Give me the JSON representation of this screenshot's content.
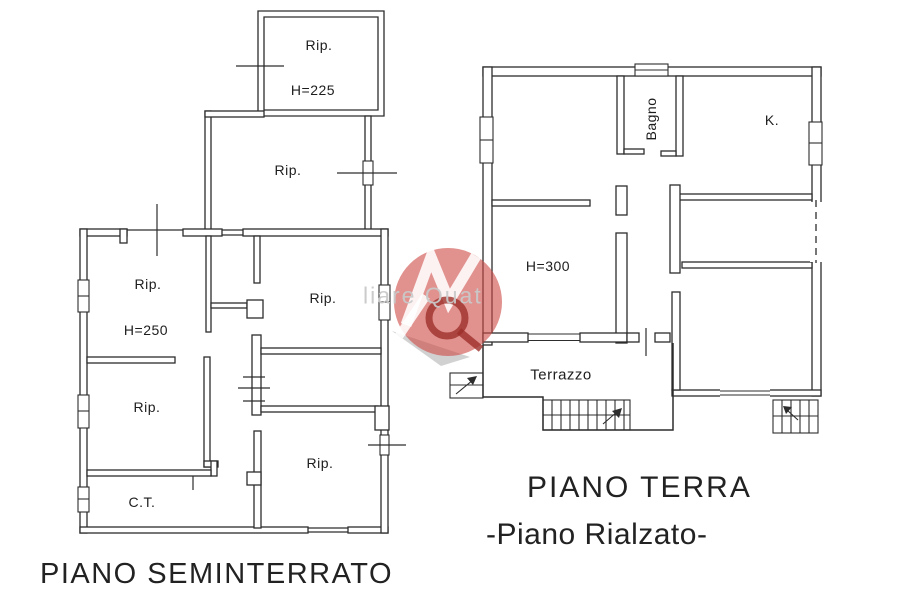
{
  "colors": {
    "ink": "#2d2d2d",
    "watermark_red": "#cd4842",
    "watermark_dark_red": "#9e2f2b",
    "watermark_gray": "#9a9a9a"
  },
  "seminterrato": {
    "title": "PIANO SEMINTERRATO",
    "labels": {
      "top_room": "Rip.",
      "top_room_height": "H=225",
      "upper_room": "Rip.",
      "nw_room": "Rip.",
      "nw_room_height": "H=250",
      "ne_room": "Rip.",
      "west_room": "Rip.",
      "se_room": "Rip.",
      "boiler": "C.T."
    }
  },
  "terra": {
    "title": "PIANO TERRA",
    "subtitle": "-Piano Rialzato-",
    "labels": {
      "bathroom": "Bagno",
      "kitchen": "K.",
      "living_height": "H=300",
      "terrace": "Terrazzo"
    }
  },
  "watermark": {
    "visible_text": "liare Quat"
  }
}
